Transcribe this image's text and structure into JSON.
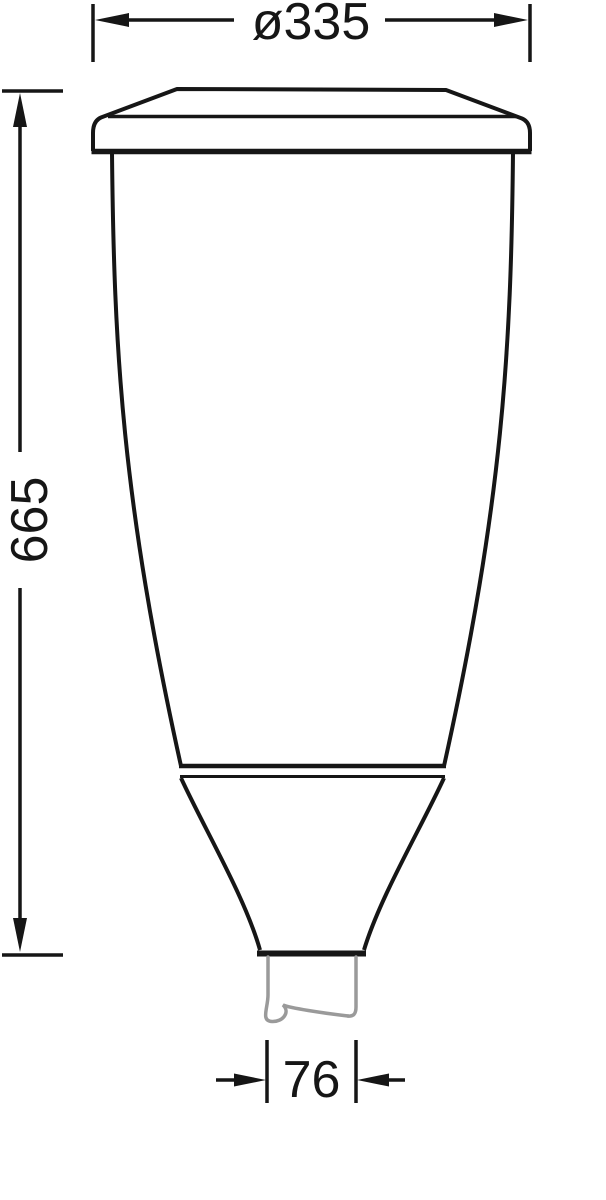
{
  "colors": {
    "line": "#161616",
    "pole_gray": "#9a9a9a",
    "background": "#ffffff"
  },
  "dimensions": {
    "diameter": {
      "label": "ø335"
    },
    "height": {
      "label": "665"
    },
    "spigot_width": {
      "label": "76"
    }
  }
}
